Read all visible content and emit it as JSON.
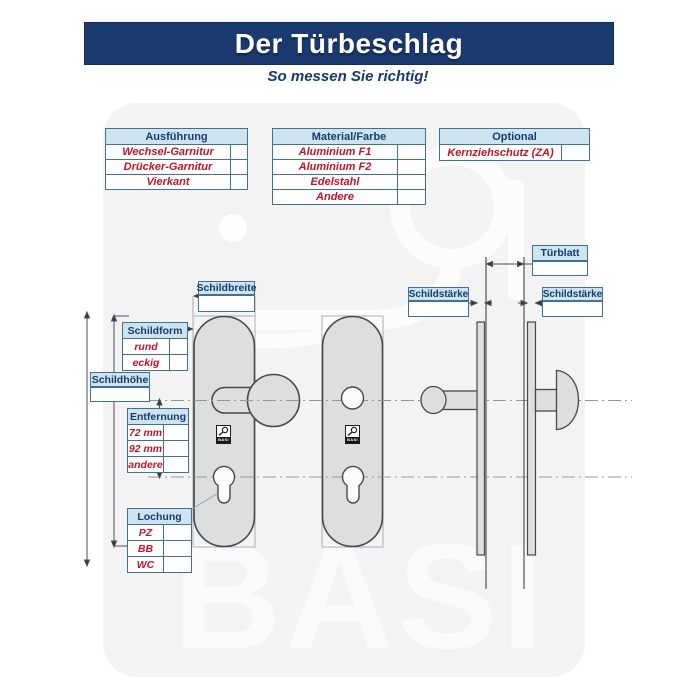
{
  "header": {
    "title": "Der Türbeschlag",
    "subtitle": "So messen Sie richtig!"
  },
  "tables": {
    "ausfuehrung": {
      "header": "Ausführung",
      "rows": [
        "Wechsel-Garnitur",
        "Drücker-Garnitur",
        "Vierkant"
      ]
    },
    "material": {
      "header": "Material/Farbe",
      "rows": [
        "Aluminium F1",
        "Aluminium F2",
        "Edelstahl",
        "Andere"
      ]
    },
    "optional": {
      "header": "Optional",
      "rows": [
        "Kernziehschutz (ZA)"
      ]
    }
  },
  "dims": {
    "schildbreite": "Schildbreite",
    "schildform": {
      "header": "Schildform",
      "rows": [
        "rund",
        "eckig"
      ]
    },
    "schildhoehe": "Schildhöhe",
    "entfernung": {
      "header": "Entfernung",
      "rows": [
        "72 mm",
        "92 mm",
        "andere"
      ]
    },
    "lochung": {
      "header": "Lochung",
      "rows": [
        "PZ",
        "BB",
        "WC"
      ]
    },
    "tuerblatt": "Türblatt",
    "schildstaerke_left": "Schildstärke",
    "schildstaerke_right": "Schildstärke"
  },
  "watermark": {
    "text": "BASI"
  },
  "plate_logo": {
    "text": "BASI"
  },
  "colors": {
    "navy": "#1a3a70",
    "label_fill": "#cde4f0",
    "table_border": "#44708e",
    "value_red": "#c01528",
    "plate_gray": "#dcdfde",
    "watermark_gray": "#f3f3f3"
  }
}
